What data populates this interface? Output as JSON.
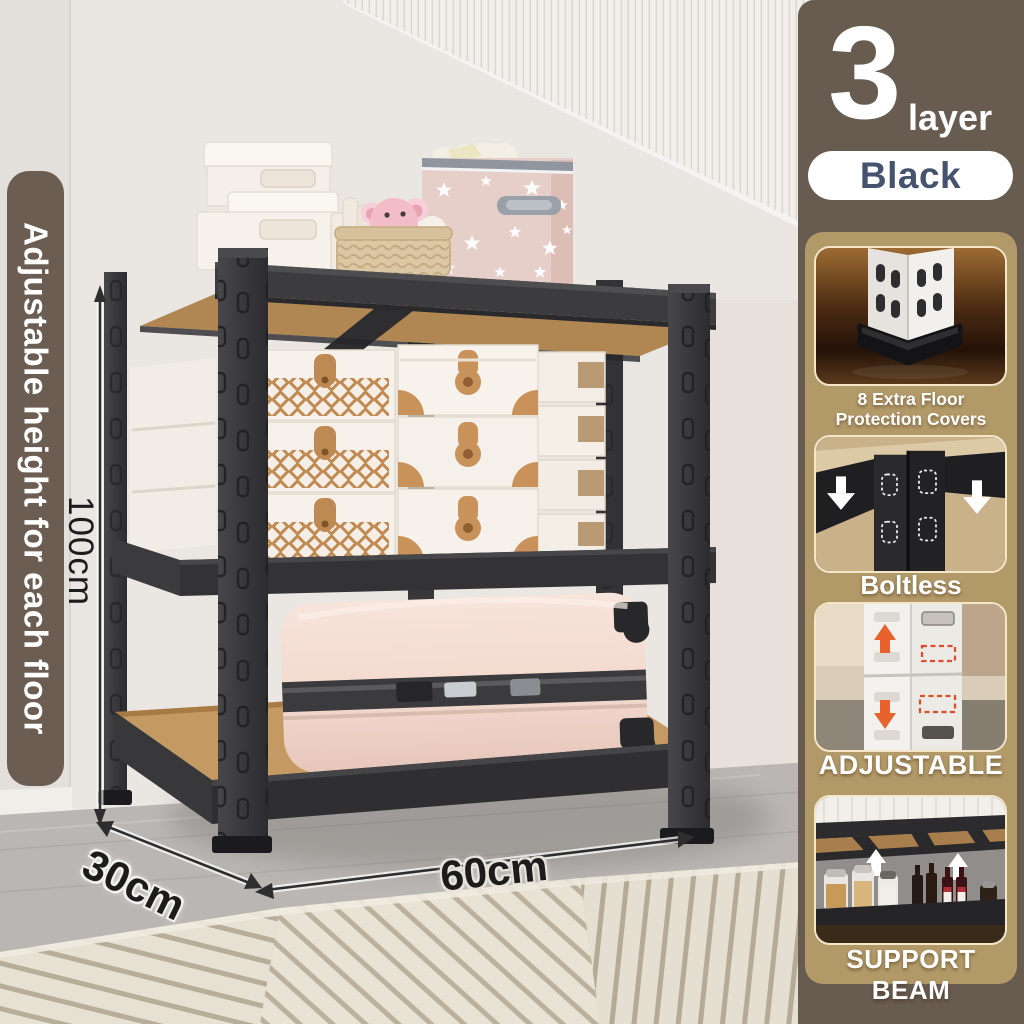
{
  "banner": {
    "text": "Adjustable height for each floor"
  },
  "dimensions": {
    "height": "100cm",
    "depth": "30cm",
    "width": "60cm"
  },
  "layer_badge": {
    "number": "3",
    "label": "layer"
  },
  "color_option": {
    "label": "Black"
  },
  "features": [
    {
      "lines": [
        "8 Extra Floor",
        "Protection Covers"
      ]
    },
    {
      "lines": [
        "Boltless"
      ]
    },
    {
      "lines": [
        "ADJUSTABLE"
      ]
    },
    {
      "lines": [
        "SUPPORT BEAM"
      ]
    }
  ],
  "colors": {
    "sidebar_brown": "#685B50",
    "panel_tan": "#B29968",
    "banner_brown": "#6B5D52",
    "pill_bg": "#FFFFFF",
    "pill_text_navy": "#46536E",
    "caption_white": "#FFFFFF",
    "dimension_text": "#1C1C1C",
    "adjust_arrow_orange": "#E8622E",
    "shelf_metal_dark": "#3C3C3E",
    "shelf_wood_tan": "#C1945C"
  }
}
